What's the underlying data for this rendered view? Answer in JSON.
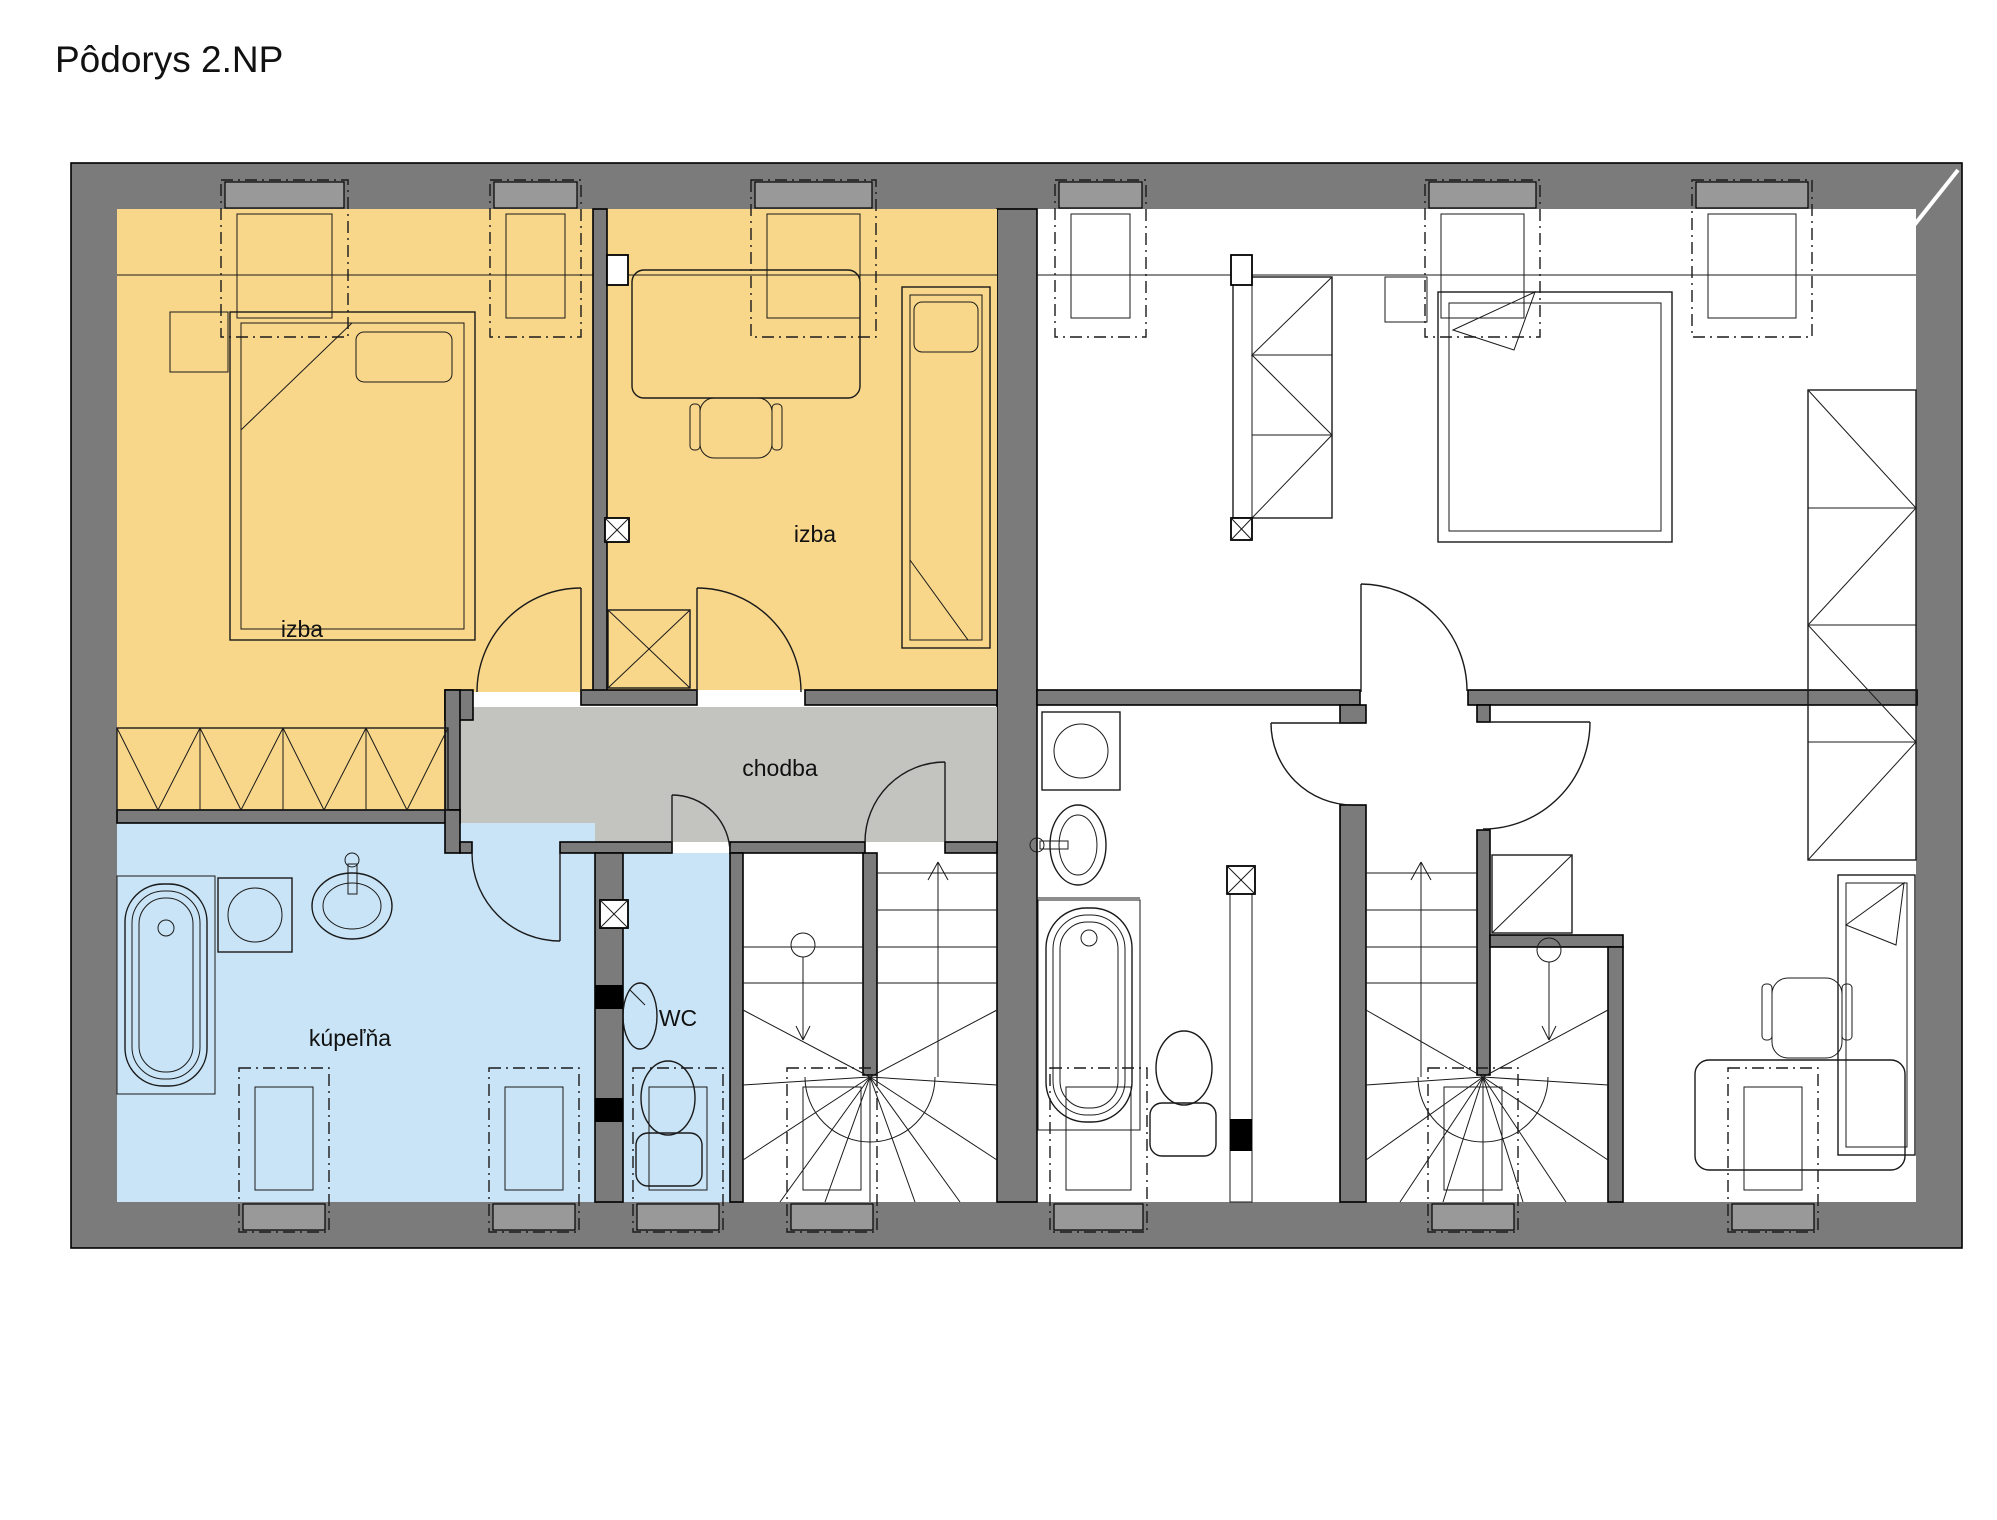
{
  "title": "Pôdorys 2.NP",
  "rooms": {
    "izba1": "izba",
    "izba2": "izba",
    "chodba": "chodba",
    "kupelna": "kúpeľňa",
    "wc": "WC"
  },
  "colors": {
    "wall": "#7b7b7b",
    "room-orange": "#f8d78b",
    "room-blue": "#c9e4f6",
    "corridor": "#c3c3c0",
    "window-band": "#999999"
  }
}
